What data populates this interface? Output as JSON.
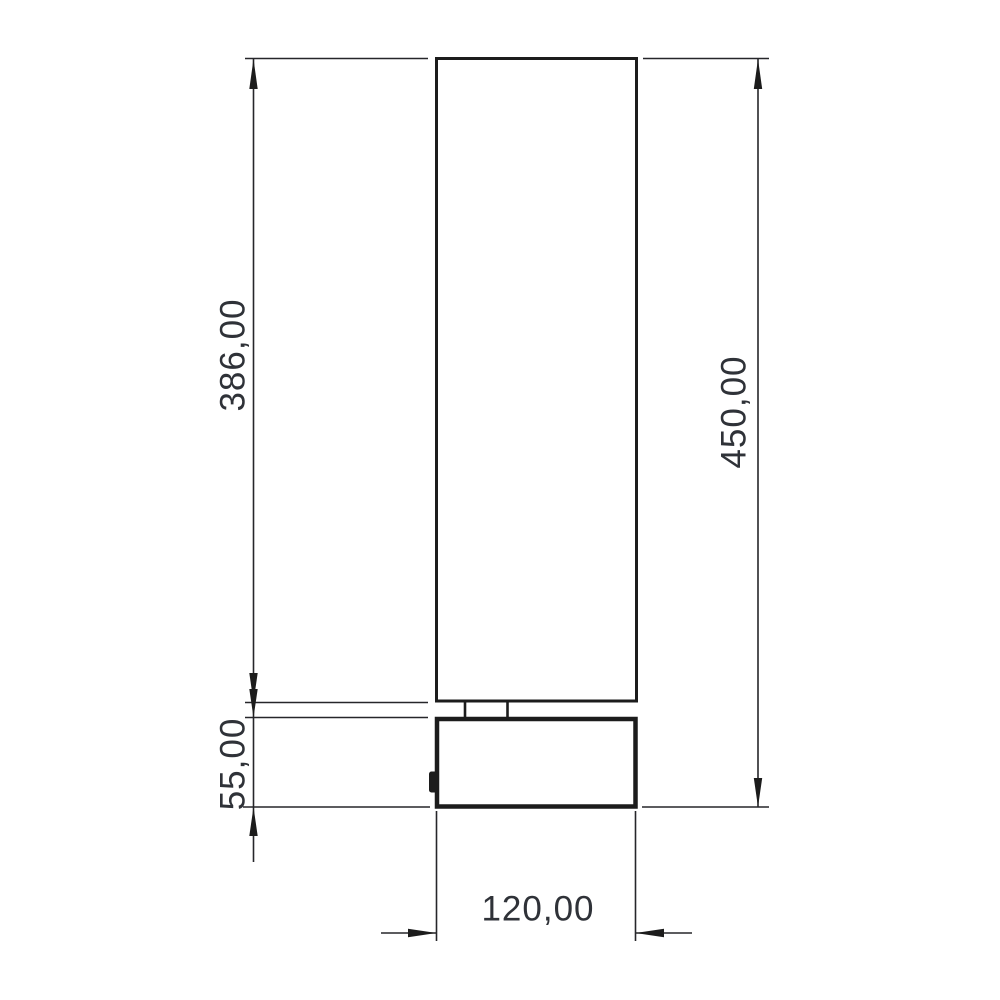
{
  "drawing": {
    "kind": "dimensioned-technical-drawing",
    "subject": "cylindrical table lamp, side elevation",
    "background_color": "#ffffff",
    "line_color": "#1e1e1e",
    "thin_line_color": "#26262a",
    "text_color": "#2f3238",
    "dimensions": [
      {
        "id": "shade-height",
        "label": "386,00",
        "value": 386.0,
        "orientation": "vertical",
        "side": "left"
      },
      {
        "id": "overall-height",
        "label": "450,00",
        "value": 450.0,
        "orientation": "vertical",
        "side": "right"
      },
      {
        "id": "base-height",
        "label": "55,00",
        "value": 55.0,
        "orientation": "vertical",
        "side": "left"
      },
      {
        "id": "base-width",
        "label": "120,00",
        "value": 120.0,
        "orientation": "horizontal",
        "side": "bottom"
      }
    ],
    "parts": [
      {
        "id": "shade",
        "shape": "rectangle"
      },
      {
        "id": "neck",
        "shape": "rectangle"
      },
      {
        "id": "base",
        "shape": "rectangle"
      },
      {
        "id": "switch",
        "shape": "bump"
      }
    ]
  }
}
